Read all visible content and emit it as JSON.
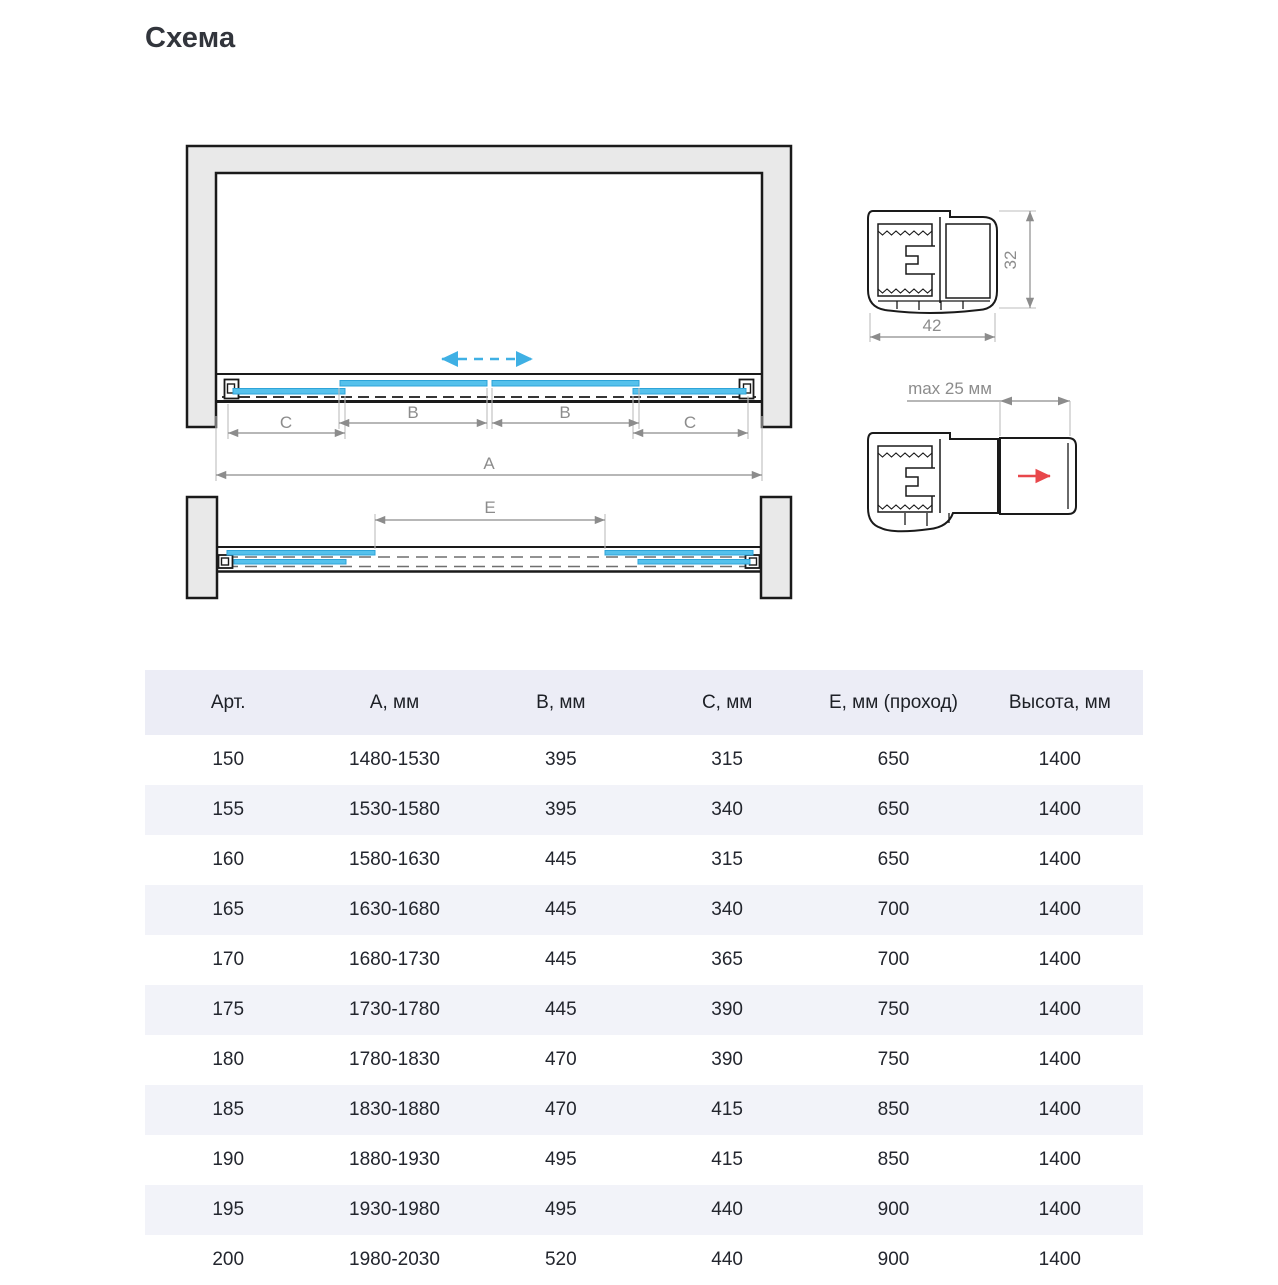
{
  "title": "Схема",
  "diagram": {
    "labels": {
      "A": "A",
      "B": "B",
      "C": "C",
      "E": "E"
    },
    "profile_top": {
      "width": "42",
      "height": "32"
    },
    "profile_bottom": {
      "max": "max 25 мм"
    },
    "colors": {
      "panel_blue": "#55C1EC",
      "wall_gray": "#E9E9E9",
      "dimension_gray": "#8C8C8C",
      "arrow_red": "#E8474B"
    }
  },
  "table": {
    "headers": [
      "Арт.",
      "А, мм",
      "В, мм",
      "С, мм",
      "Е, мм (проход)",
      "Высота, мм"
    ],
    "rows": [
      [
        "150",
        "1480-1530",
        "395",
        "315",
        "650",
        "1400"
      ],
      [
        "155",
        "1530-1580",
        "395",
        "340",
        "650",
        "1400"
      ],
      [
        "160",
        "1580-1630",
        "445",
        "315",
        "650",
        "1400"
      ],
      [
        "165",
        "1630-1680",
        "445",
        "340",
        "700",
        "1400"
      ],
      [
        "170",
        "1680-1730",
        "445",
        "365",
        "700",
        "1400"
      ],
      [
        "175",
        "1730-1780",
        "445",
        "390",
        "750",
        "1400"
      ],
      [
        "180",
        "1780-1830",
        "470",
        "390",
        "750",
        "1400"
      ],
      [
        "185",
        "1830-1880",
        "470",
        "415",
        "850",
        "1400"
      ],
      [
        "190",
        "1880-1930",
        "495",
        "415",
        "850",
        "1400"
      ],
      [
        "195",
        "1930-1980",
        "495",
        "440",
        "900",
        "1400"
      ],
      [
        "200",
        "1980-2030",
        "520",
        "440",
        "900",
        "1400"
      ]
    ]
  }
}
